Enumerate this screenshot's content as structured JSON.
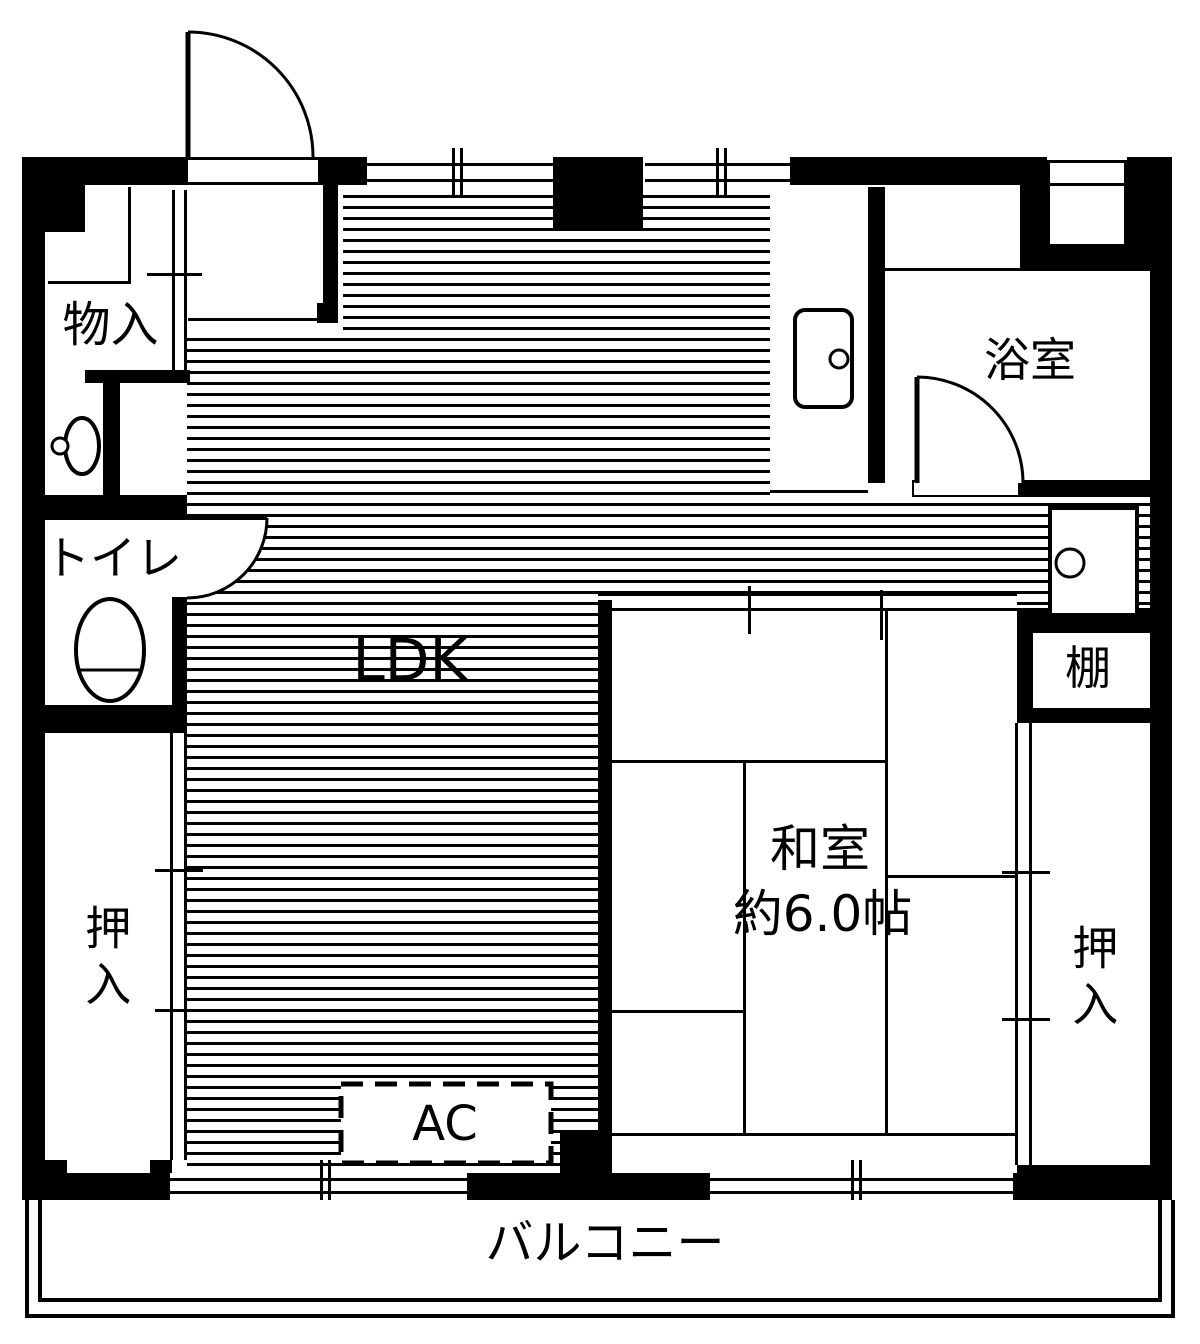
{
  "plan_title": "2DK floor plan",
  "colors": {
    "line": "#000000",
    "background": "#ffffff"
  },
  "rooms": {
    "storage": {
      "label": "物入"
    },
    "toilet": {
      "label": "トイレ"
    },
    "ldk": {
      "label": "LDK"
    },
    "bathroom": {
      "label": "浴室"
    },
    "shelf": {
      "label": "棚"
    },
    "washitsu": {
      "label": "和室",
      "size": "約6.0帖"
    },
    "closet_left": {
      "label": "押入"
    },
    "closet_right": {
      "label": "押入"
    },
    "balcony": {
      "label": "バルコニー"
    }
  },
  "equipment": {
    "ac": {
      "label": "AC"
    }
  },
  "fixtures": {
    "toilet_bowl": "toilet-bowl",
    "washbasin": "washbasin",
    "washing_machine_pan": "washing-machine-pan",
    "kitchen_sink": "kitchen-sink"
  }
}
